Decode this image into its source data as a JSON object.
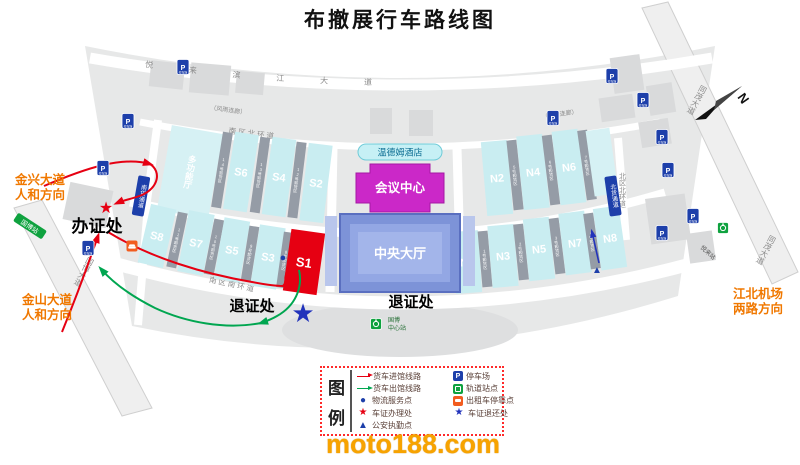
{
  "title": "布撤展行车路线图",
  "watermark": "moto188.com",
  "compass_n": "N",
  "buildings": {
    "hotel": "温德姆酒店",
    "conference": "会议中心",
    "central_hall": "中央大厅",
    "multi_hall": "多功能厅",
    "s8": "S8",
    "s7": "S7",
    "s6": "S6",
    "s5": "S5",
    "s4": "S4",
    "s3": "S3",
    "s2": "S2",
    "s1": "S1",
    "n1": "N1",
    "n2": "N2",
    "n3": "N3",
    "n4": "N4",
    "n5": "N5",
    "n6": "N6",
    "n7": "N7",
    "n8": "N8"
  },
  "strips": {
    "u14": "14号卸货区",
    "u13": "13号卸货区",
    "u12": "12号卸货区",
    "u11": "11号卸货区",
    "u10": "10号卸货区",
    "u9": "9号卸货区",
    "u8": "8号卸货区",
    "n1": "1号卸货区",
    "n2": "2号卸货区",
    "n3": "3号卸货区",
    "n4": "4号卸货区",
    "n5": "5号卸货区",
    "n6": "6号卸货区",
    "n7": "7号卸货区"
  },
  "roads": {
    "binjiang": "悦来滨江大道",
    "guobo": "国博大道",
    "tongmao": "同茂大道",
    "s_north": "南区北环道",
    "s_south": "南区南环道",
    "n_south": "北区南环道",
    "n_north": "北区北环道",
    "canopy": "（风雨连廊）",
    "south_gate": "南货通道",
    "north_gate": "北货通道"
  },
  "stations": {
    "gbc1": "国博",
    "gbc2": "中心站",
    "yuelai": "悦来站",
    "guobo": "国博站"
  },
  "poi": {
    "permit": "办证处",
    "return1": "退证处",
    "return2": "退证处"
  },
  "directions": {
    "jx1": "金兴大道",
    "jx2": "人和方向",
    "js1": "金山大道",
    "js2": "人和方向",
    "ap1": "江北机场",
    "ap2": "两路方向"
  },
  "legend": {
    "t1": "图",
    "t2": "例",
    "left": [
      "货车进馆线路",
      "货车出馆线路",
      "物流服务点",
      "车证办理处",
      "公安执勤点"
    ],
    "right": [
      "停车场",
      "轨道站点",
      "出租车停靠点",
      "车证退还处"
    ]
  },
  "icons": {
    "parking": "P",
    "parking_sub": "停车场",
    "star": "★",
    "dot": "●",
    "tri": "▲"
  },
  "colors": {
    "route_in": "#e60012",
    "route_out": "#00a650",
    "hall_cyan": "#c9edf1",
    "s1_red": "#e60012",
    "conference_magenta": "#cb28c8",
    "central_blue": "#7d93d8",
    "parking_blue": "#1d3faa",
    "rail_green": "#0fa23f",
    "taxi_orange": "#f25c1f",
    "direction_orange": "#f07800"
  }
}
